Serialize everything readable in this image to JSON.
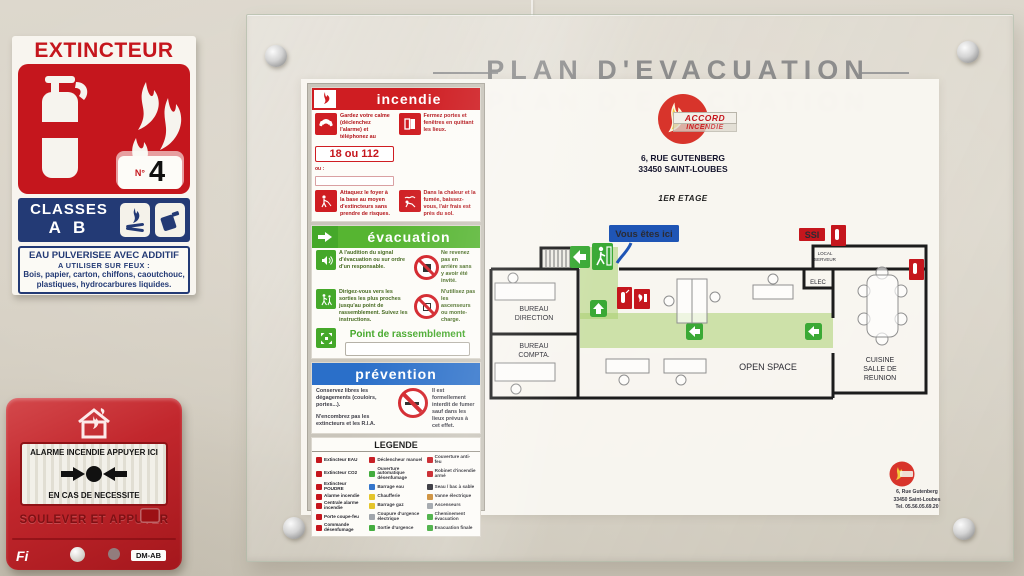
{
  "extinguisher_sign": {
    "title": "EXTINCTEUR",
    "number_label": "N°",
    "number": "4",
    "classes_label": "CLASSES",
    "classes_value": "A B",
    "usage_title": "EAU PULVERISEE AVEC ADDITIF",
    "usage_subtitle": "A UTILISER SUR FEUX :",
    "usage_text": "Bois, papier, carton, chiffons, caoutchouc, plastiques, hydrocarbures liquides.",
    "accent_color": "#c5161d",
    "band_color": "#233a75"
  },
  "alarm": {
    "line1": "ALARME INCENDIE APPUYER ICI",
    "line2": "EN CAS DE NECESSITE",
    "lift_label": "SOULEVER ET APPUYER",
    "brand": "Fi",
    "model_label": "DM-AB",
    "body_color": "#c2272d"
  },
  "plan": {
    "title": "PLAN D'EVACUATION",
    "logo_top": "ACCORD",
    "logo_bottom": "INCENDIE",
    "address_line1": "6, RUE GUTENBERG",
    "address_line2": "33450 SAINT-LOUBES",
    "floor_label": "1ER ETAGE",
    "incendie": {
      "title": "incendie",
      "cell1_text": "Gardez votre calme (déclenchez l'alarme) et téléphonez au",
      "phone": "18 ou 112",
      "or_label": "ou :",
      "cell2_text": "Fermez portes et fenêtres en quittant les lieux.",
      "cell3_text": "Attaquez le foyer à la base au moyen d'extincteurs sans prendre de risques.",
      "cell4_text": "Dans la chaleur et la fumée, baissez-vous, l'air frais est près du sol."
    },
    "evacuation": {
      "title": "évacuation",
      "row1_text": "A l'audition du signal d'évacuation ou sur ordre d'un responsable.",
      "row1_right": "Ne revenez pas en arrière sans y avoir été invité.",
      "row2_text": "Dirigez-vous vers les sorties les plus proches jusqu'au point de rassemblement. Suivez les instructions.",
      "row2_right": "N'utilisez pas les ascenseurs ou monte-charge.",
      "assembly_label": "Point de rassemblement"
    },
    "prevention": {
      "title": "prévention",
      "left1": "Conservez libres les dégagements (couloirs, portes...).",
      "left2": "N'encombrez pas les extincteurs et les R.I.A.",
      "right": "Il est formellement interdit de fumer sauf dans les lieux prévus à cet effet."
    },
    "legende": {
      "title": "LEGENDE",
      "col1": [
        "Extincteur EAU",
        "Extincteur CO2",
        "Extincteur POUDRE",
        "Alarme incendie",
        "Centrale alarme incendie",
        "Porte coupe-feu",
        "Commande désenfumage"
      ],
      "col2": [
        "Déclencheur manuel",
        "Ouverture automatique désenfumage",
        "Barrage eau",
        "Chaufferie",
        "Barrage gaz",
        "Coupure d'urgence électrique",
        "Sortie d'urgence"
      ],
      "col3": [
        "Couverture anti-feu",
        "Robinet d'incendie armé",
        "Seau / bac à sable",
        "Vanne électrique",
        "Ascenseurs",
        "Cheminement évacuation",
        "Evacuation finale"
      ]
    },
    "map": {
      "you_are_here": "Vous êtes ici",
      "ssi": "SSI",
      "rooms": {
        "direction": [
          "BUREAU",
          "DIRECTION"
        ],
        "compta": [
          "BUREAU",
          "COMPTA."
        ],
        "open_space": "OPEN SPACE",
        "cuisine": [
          "CUISINE",
          "SALLE DE",
          "REUNION"
        ],
        "serveur": [
          "LOCAL",
          "SERVEUR"
        ],
        "elec": "ELEC"
      },
      "path_color": "#8dc63f",
      "exit_color": "#3aa935",
      "marker_color": "#c5161d"
    },
    "footer": {
      "line1": "6, Rue Gutenberg",
      "line2": "33450 Saint-Loubes",
      "line3": "Tel. 05.56.05.69.20"
    }
  }
}
